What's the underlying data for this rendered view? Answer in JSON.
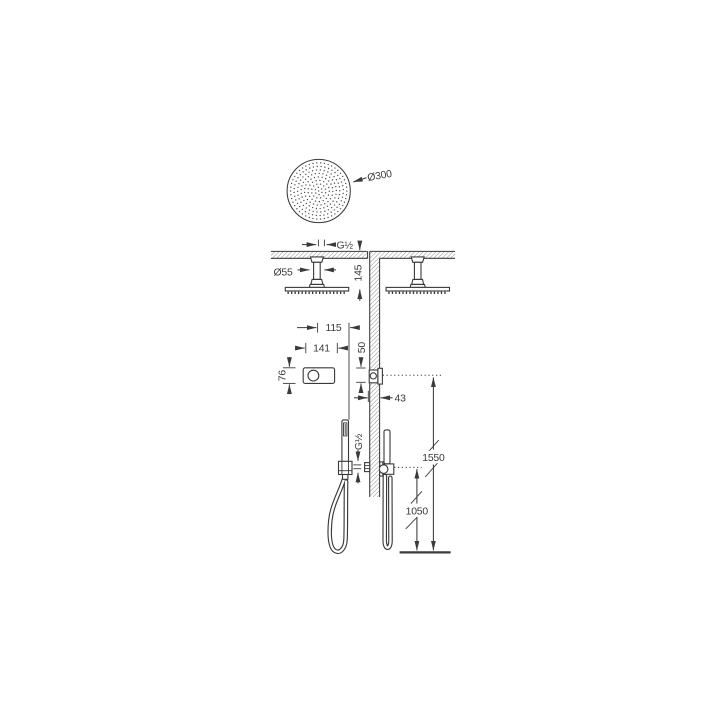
{
  "drawing_type": "shower-system-dimension-diagram",
  "labels": {
    "rain_head_diameter": "Ø300",
    "ceiling_connection_thread": "G½",
    "ceiling_escutcheon_diameter": "Ø55",
    "ceiling_arm_drop": "145",
    "control_center_offset": "115",
    "control_width": "141",
    "control_height": "76",
    "control_outlet_spacing": "50",
    "control_recess_depth": "43",
    "handshower_thread": "G½",
    "control_height_above_floor": "1550",
    "handshower_height_above_floor": "1050"
  },
  "colors": {
    "line": "#3a3a3a",
    "hatch": "#8f8f8f",
    "nozzle_dots": "#4a4a4a",
    "background": "#ffffff"
  }
}
